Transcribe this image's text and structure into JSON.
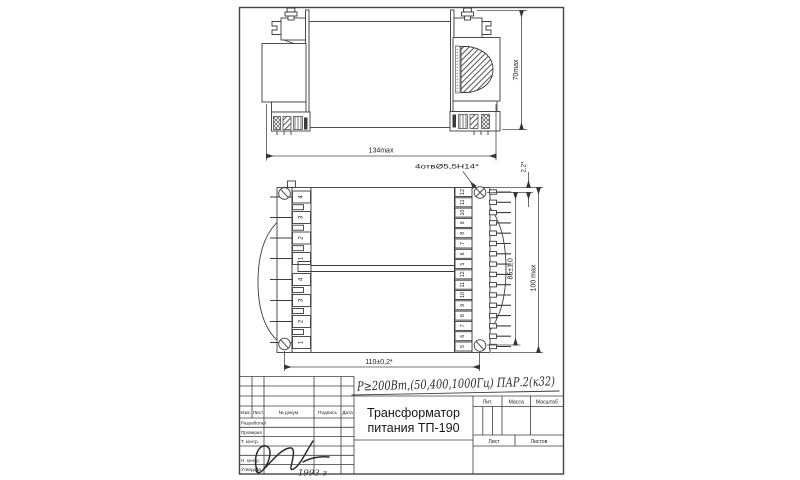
{
  "drawing": {
    "dims": {
      "top_width": "134max",
      "top_height": "70max",
      "holes_note": "4отвØ5,5Н14*",
      "top_offset": "2,2*",
      "mid_height": "85±1,0",
      "total_height": "100 max",
      "bottom_width": "110±0,2*"
    },
    "front_view": {
      "left_terminals": [
        "4",
        "3",
        "2",
        "1",
        "4",
        "3",
        "2",
        "1"
      ],
      "right_terminals": [
        "12",
        "11",
        "10",
        "9",
        "8",
        "7",
        "6",
        "5",
        "12",
        "11",
        "10",
        "9",
        "8",
        "7",
        "6",
        "5"
      ]
    }
  },
  "notes": {
    "power_note": "P≥200Вт,(50,400,1000Гц) ПАР.2(к32)",
    "year": "1993 г"
  },
  "title_block": {
    "doc_title_1": "Трансформатор",
    "doc_title_2": "питания ТП-190",
    "header_cols": [
      "Изм.",
      "Лист",
      "№ докум.",
      "Подпись",
      "Дата"
    ],
    "row_labels": [
      "Разработал",
      "Проверил",
      "Т. контр.",
      "Н. контр.",
      "Утвердил"
    ],
    "lit": "Лит.",
    "mass": "Масса",
    "scale": "Масштаб",
    "sheet": "Лист",
    "sheets": "Листов"
  }
}
